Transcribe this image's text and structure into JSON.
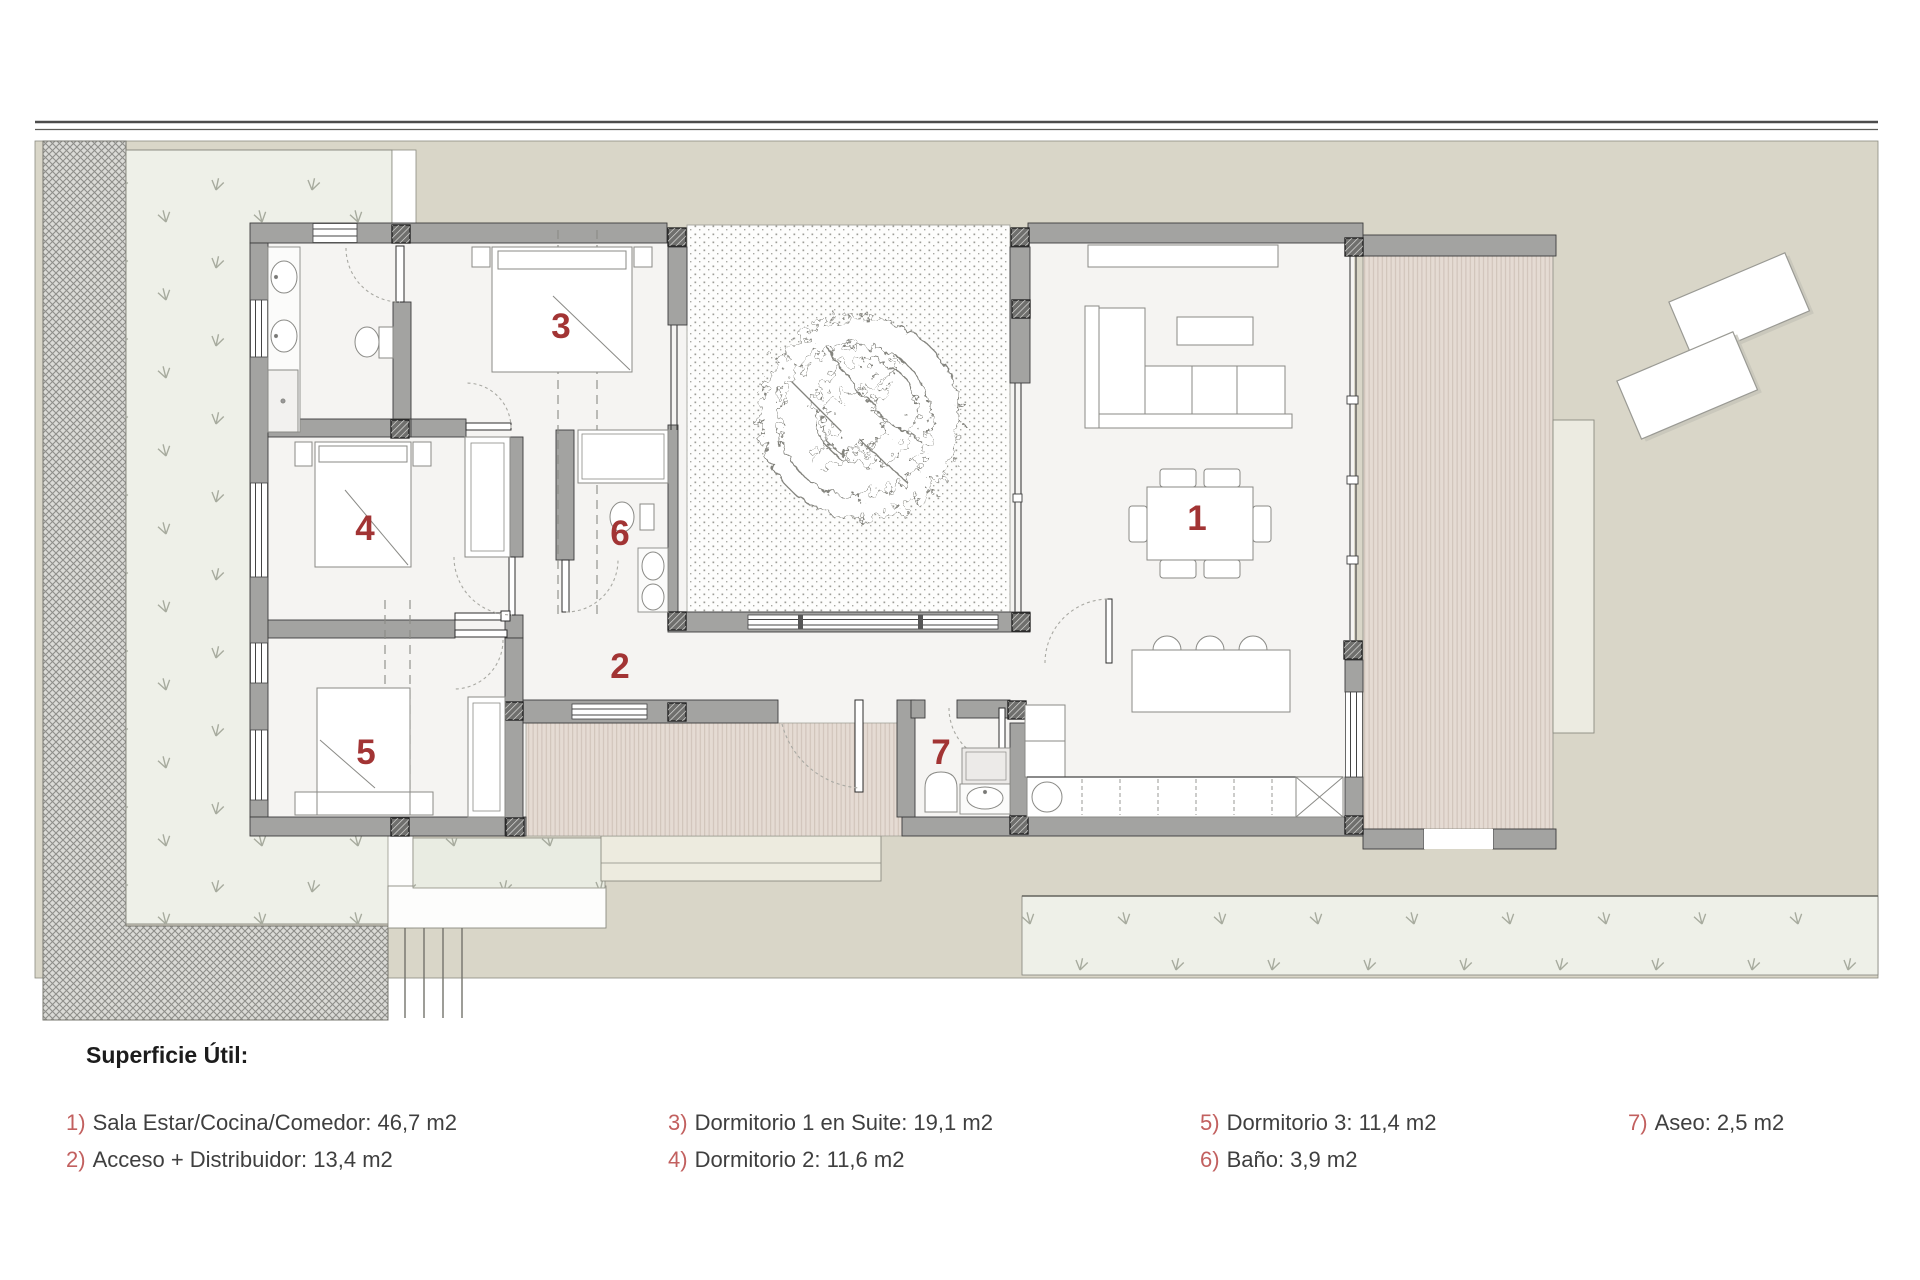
{
  "plan": {
    "room_labels": [
      {
        "num": "1"
      },
      {
        "num": "2"
      },
      {
        "num": "3"
      },
      {
        "num": "4"
      },
      {
        "num": "5"
      },
      {
        "num": "6"
      },
      {
        "num": "7"
      }
    ],
    "colors": {
      "label_red": "#a23434",
      "legend_number_red": "#c2605f",
      "wall_gray": "#a3a3a1",
      "terrain": "#d9d6c8",
      "grass": "#eef0e8",
      "deck_wood": "#e4dad2"
    }
  },
  "legend": {
    "title": "Superficie Útil:",
    "items": [
      {
        "num": "1)",
        "text": "Sala Estar/Cocina/Comedor: 46,7 m2"
      },
      {
        "num": "2)",
        "text": "Acceso + Distribuidor: 13,4 m2"
      },
      {
        "num": "3)",
        "text": "Dormitorio 1 en Suite: 19,1 m2"
      },
      {
        "num": "4)",
        "text": "Dormitorio 2: 11,6 m2"
      },
      {
        "num": "5)",
        "text": "Dormitorio 3: 11,4 m2"
      },
      {
        "num": "6)",
        "text": "Baño: 3,9 m2"
      },
      {
        "num": "7)",
        "text": "Aseo: 2,5 m2"
      }
    ]
  }
}
